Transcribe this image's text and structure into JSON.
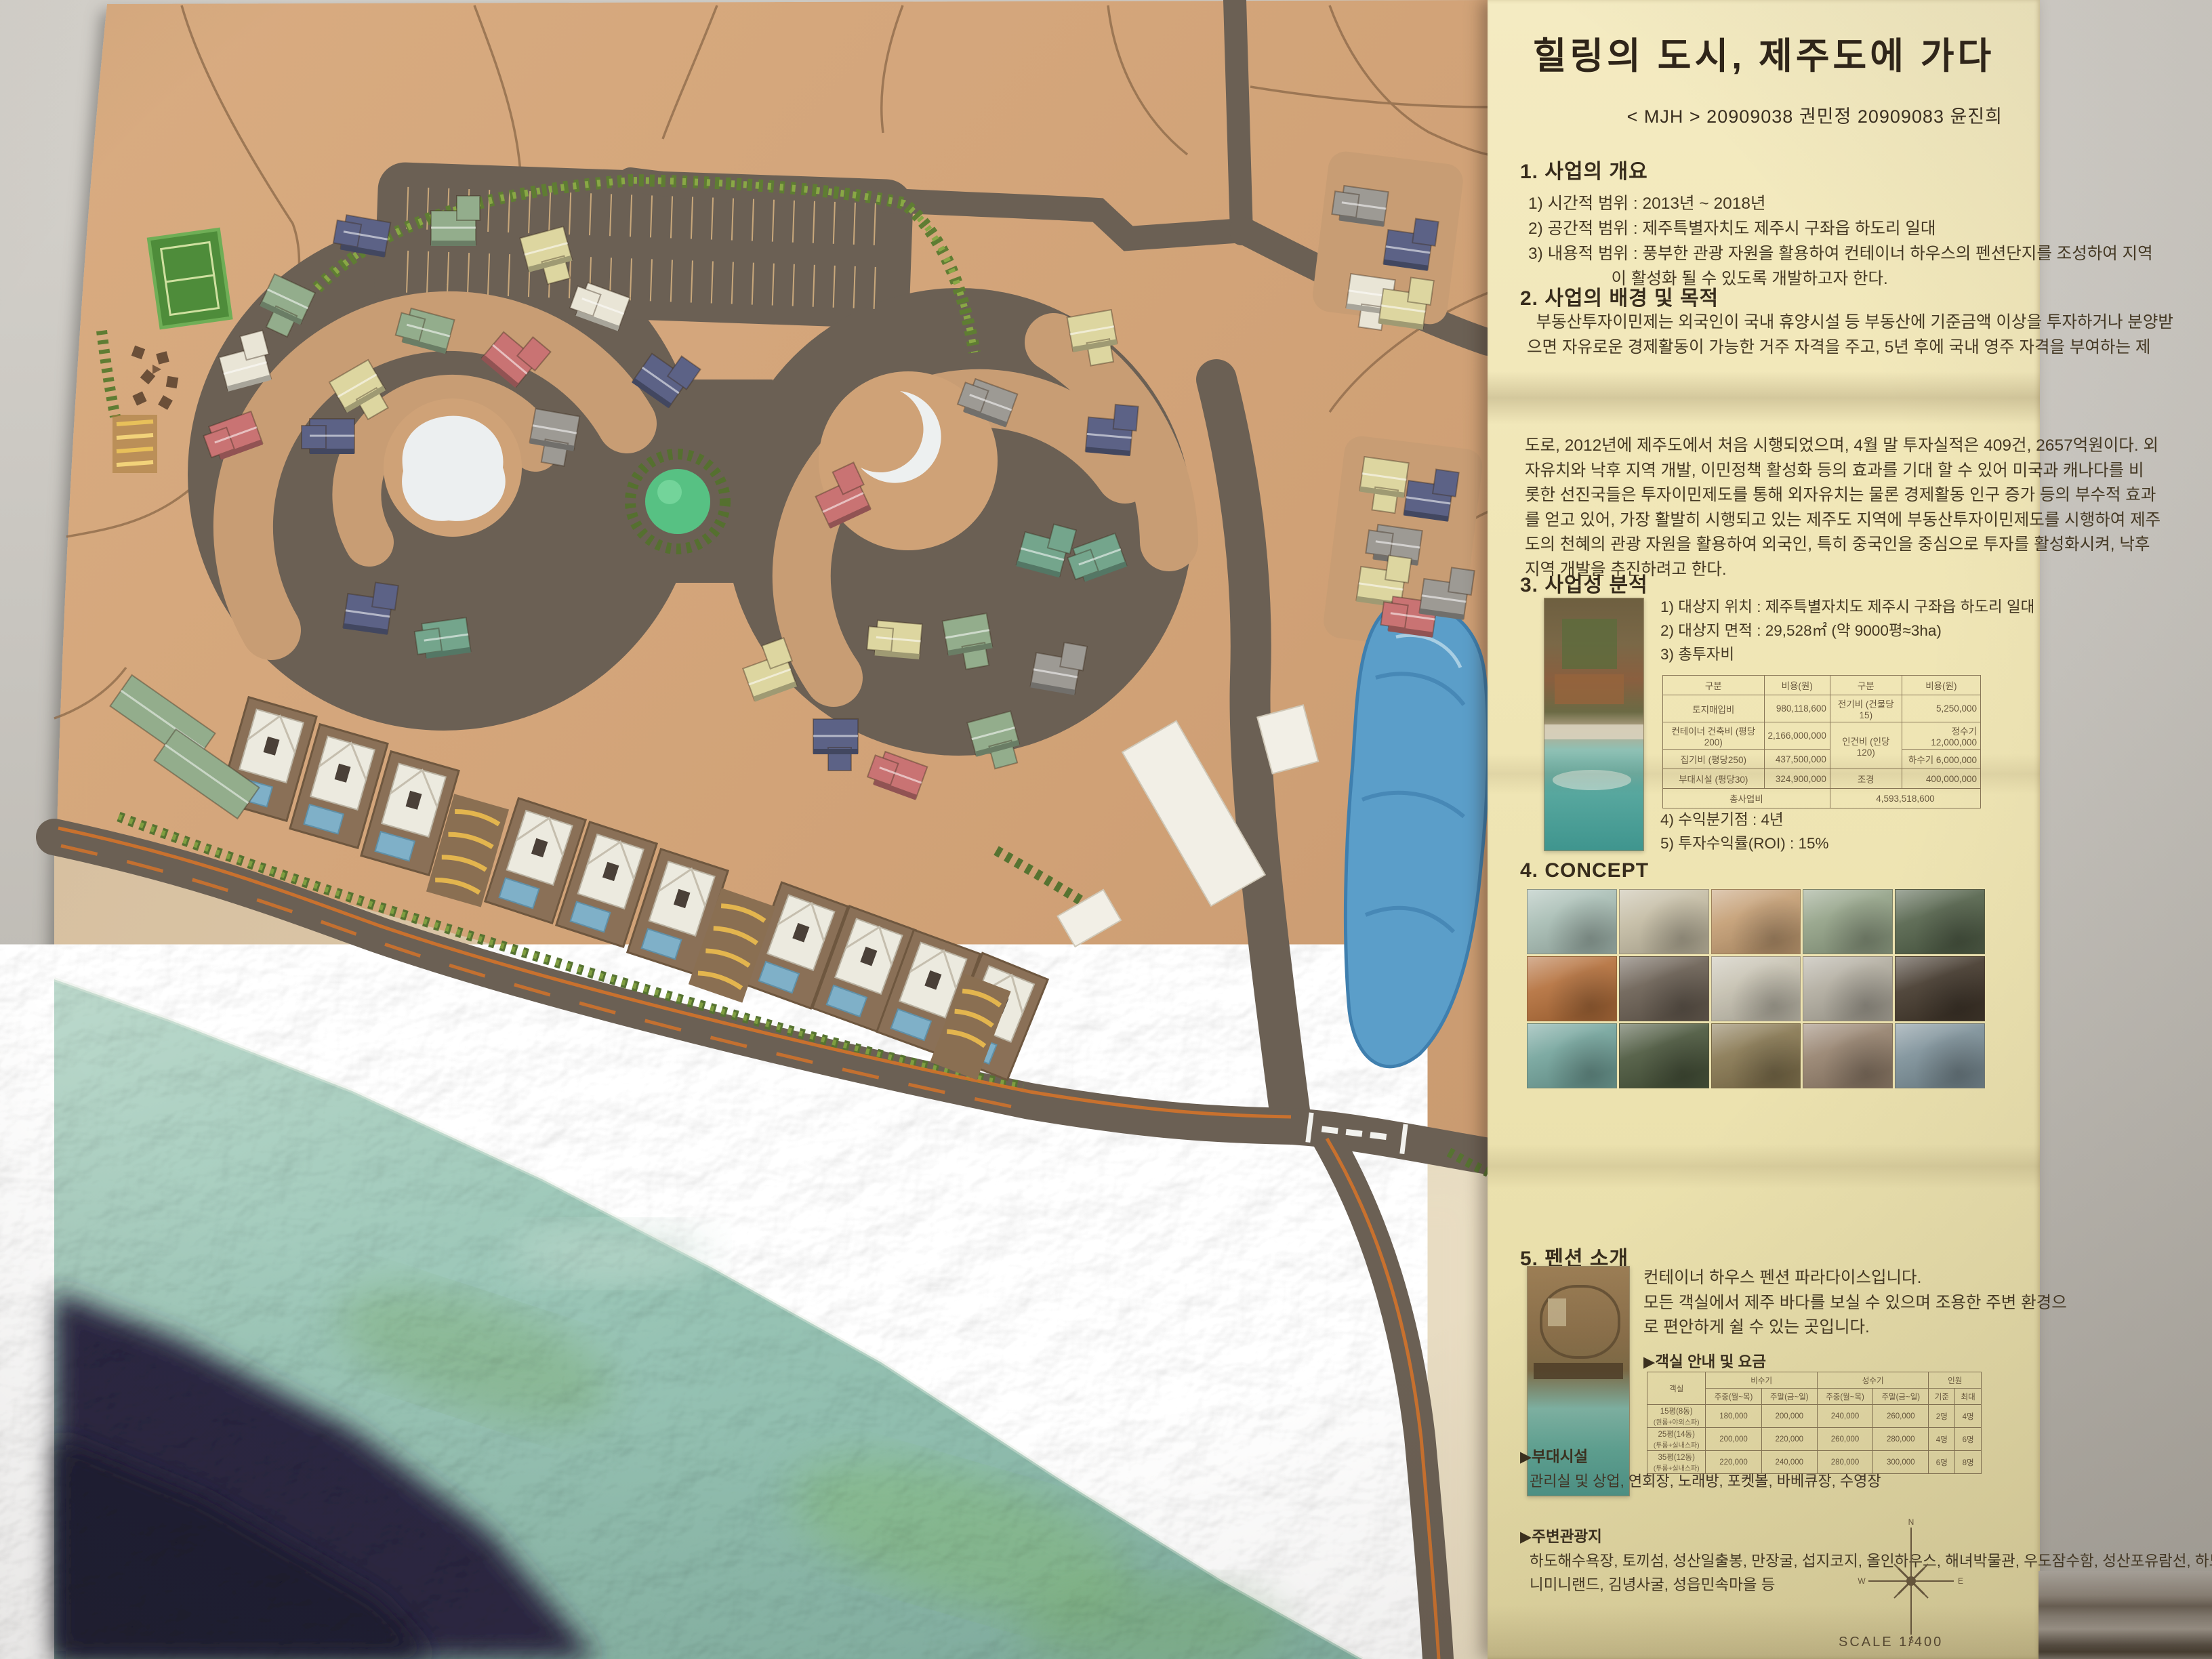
{
  "panel": {
    "title": "힐링의 도시, 제주도에 가다",
    "subtitle": "< MJH > 20909038 권민정 20909083 윤진희",
    "s1": {
      "heading": "1. 사업의 개요",
      "lines": [
        "1) 시간적 범위 : 2013년 ~ 2018년",
        "2) 공간적 범위 : 제주특별자치도 제주시 구좌읍 하도리 일대",
        "3) 내용적 범위 : 풍부한 관광 자원을 활용하여 컨테이너 하우스의 펜션단지를 조성하여 지역",
        "                  이 활성화 될 수 있도록 개발하고자 한다."
      ]
    },
    "s2": {
      "heading": "2. 사업의 배경 및 목적",
      "para1": [
        "  부동산투자이민제는 외국인이 국내 휴양시설 등 부동산에 기준금액 이상을 투자하거나 분양받",
        "으면 자유로운 경제활동이 가능한 거주 자격을 주고, 5년 후에 국내 영주 자격을 부여하는 제"
      ],
      "para2": [
        "도로, 2012년에 제주도에서 처음 시행되었으며, 4월 말 투자실적은 409건, 2657억원이다. 외",
        "자유치와 낙후 지역 개발, 이민정책 활성화 등의 효과를 기대 할 수 있어 미국과 캐나다를 비",
        "롯한 선진국들은 투자이민제도를 통해 외자유치는 물론 경제활동 인구 증가 등의 부수적 효과",
        "를 얻고 있어, 가장 활발히 시행되고 있는 제주도 지역에 부동산투자이민제도를 시행하여 제주",
        "도의 천혜의 관광 자원을 활용하여 외국인, 특히 중국인을 중심으로 투자를 활성화시켜, 낙후",
        "지역 개발을 추진하려고 한다."
      ]
    },
    "s3": {
      "heading": "3. 사업성 분석",
      "items": [
        "1) 대상지 위치 : 제주특별자치도 제주시 구좌읍 하도리 일대",
        "2) 대상지 면적 : 29,528㎡ (약 9000평≈3ha)",
        "3) 총투자비"
      ],
      "items2": [
        "4) 수익분기점 : 4년",
        "5) 투자수익률(ROI) : 15%"
      ],
      "cost_table": {
        "headers": [
          "구분",
          "비용(원)",
          "구분",
          "비용(원)"
        ],
        "rows": [
          [
            "토지매입비",
            "980,118,600",
            "전기비 (건물당15)",
            "5,250,000"
          ],
          [
            "컨테이너 건축비 (평당200)",
            "2,166,000,000",
            "인건비 (인당120)",
            "정수기 12,000,000"
          ],
          [
            "집기비 (평당250)",
            "437,500,000",
            "",
            "하수기 6,000,000"
          ],
          [
            "부대시설 (평당30)",
            "324,900,000",
            "조경",
            "400,000,000"
          ]
        ],
        "total_label": "총사업비",
        "total_value": "4,593,518,600"
      }
    },
    "s4": {
      "heading": "4. CONCEPT",
      "tiles": [
        "#a8bdb4",
        "#c4bca4",
        "#c49e74",
        "#93a287",
        "#55644c",
        "#b4703c",
        "#6b6054",
        "#c6c1b1",
        "#b2ada0",
        "#453a2e",
        "#74a49c",
        "#4c583e",
        "#887852",
        "#97836f",
        "#7f939c"
      ]
    },
    "s5": {
      "heading": "5. 펜션 소개",
      "desc": [
        "컨테이너 하우스 펜션 파라다이스입니다.",
        "모든 객실에서 제주 바다를 보실 수 있으며 조용한 주변 환경으",
        "로 편안하게 쉴 수 있는 곳입니다."
      ],
      "table_label": "▶객실 안내 및 요금",
      "price_table": {
        "room_header": "객실",
        "groups": [
          "비수기",
          "성수기",
          "인원"
        ],
        "sub_headers": [
          "주중(월~목)",
          "주말(금~일)",
          "주중(월~목)",
          "주말(금~일)",
          "기준",
          "최대"
        ],
        "rows": [
          {
            "room": "15평(8동)",
            "room2": "(원룸+야외스파)",
            "vals": [
              "180,000",
              "200,000",
              "240,000",
              "260,000",
              "2명",
              "4명"
            ]
          },
          {
            "room": "25평(14동)",
            "room2": "(투룸+실내스파)",
            "vals": [
              "200,000",
              "220,000",
              "260,000",
              "280,000",
              "4명",
              "6명"
            ]
          },
          {
            "room": "35평(12동)",
            "room2": "(투룸+실내스파)",
            "vals": [
              "220,000",
              "240,000",
              "280,000",
              "300,000",
              "6명",
              "8명"
            ]
          }
        ]
      }
    },
    "facilities": {
      "label": "▶부대시설",
      "text": "관리실 및 상업, 연회장, 노래방, 포켓볼, 바베큐장, 수영장"
    },
    "attractions": {
      "label": "▶주변관광지",
      "lines": [
        "하도해수욕장, 토끼섬, 성산일출봉, 만장굴, 섭지코지, 올인하우스, 해녀박물관, 우도잠수함, 성산포유람선, 하도철새도래지, 미",
        "니미니랜드, 김녕사굴, 성읍민속마을 등"
      ]
    },
    "compass": {
      "n": "N",
      "e": "E",
      "s": "S",
      "w": "W"
    },
    "scale_label": "SCALE 1/400"
  },
  "model": {
    "palette": {
      "navy": "#5c6286",
      "sage": "#93ad8c",
      "teal": "#74a58c",
      "cream": "#ddd6a0",
      "ivory": "#e9e5d6",
      "red": "#c97373",
      "gray": "#9d9a94"
    },
    "houses": [
      [
        344,
        640,
        -20,
        "red",
        1
      ],
      [
        358,
        541,
        -15,
        "ivory",
        0
      ],
      [
        423,
        437,
        25,
        "sage",
        2
      ],
      [
        537,
        344,
        10,
        "navy",
        1
      ],
      [
        666,
        333,
        0,
        "sage",
        0
      ],
      [
        802,
        365,
        -15,
        "cream",
        2
      ],
      [
        888,
        448,
        20,
        "ivory",
        1
      ],
      [
        974,
        557,
        35,
        "navy",
        0
      ],
      [
        523,
        568,
        -30,
        "cream",
        2
      ],
      [
        630,
        484,
        15,
        "sage",
        1
      ],
      [
        752,
        526,
        40,
        "red",
        0
      ],
      [
        816,
        630,
        10,
        "gray",
        2
      ],
      [
        487,
        640,
        0,
        "navy",
        1
      ],
      [
        540,
        902,
        8,
        "navy",
        0
      ],
      [
        655,
        938,
        -8,
        "teal",
        1
      ],
      [
        1240,
        740,
        -25,
        "red",
        0
      ],
      [
        1323,
        940,
        5,
        "cream",
        1
      ],
      [
        1424,
        933,
        -10,
        "sage",
        2
      ],
      [
        1536,
        814,
        15,
        "teal",
        0
      ],
      [
        1460,
        590,
        20,
        "gray",
        1
      ],
      [
        1608,
        485,
        -10,
        "cream",
        2
      ],
      [
        1634,
        640,
        5,
        "navy",
        0
      ],
      [
        1619,
        820,
        -20,
        "teal",
        1
      ],
      [
        1555,
        990,
        10,
        "gray",
        0
      ],
      [
        1462,
        1080,
        -15,
        "sage",
        2
      ],
      [
        1327,
        1140,
        20,
        "red",
        1
      ],
      [
        1230,
        1083,
        0,
        "navy",
        2
      ],
      [
        1132,
        997,
        -20,
        "cream",
        0
      ],
      [
        2010,
        300,
        8,
        "gray",
        1
      ],
      [
        2075,
        365,
        8,
        "navy",
        0
      ],
      [
        2020,
        430,
        8,
        "ivory",
        2
      ],
      [
        2068,
        452,
        8,
        "cream",
        0
      ],
      [
        2040,
        700,
        8,
        "cream",
        2
      ],
      [
        2105,
        735,
        8,
        "navy",
        0
      ],
      [
        2060,
        800,
        8,
        "gray",
        1
      ],
      [
        2035,
        862,
        8,
        "cream",
        0
      ],
      [
        2082,
        906,
        8,
        "red",
        1
      ],
      [
        2128,
        880,
        8,
        "gray",
        0
      ]
    ],
    "units": [
      [
        395,
        1120,
        16
      ],
      [
        500,
        1160,
        16
      ],
      [
        605,
        1200,
        16
      ],
      [
        790,
        1270,
        18
      ],
      [
        895,
        1305,
        18
      ],
      [
        1000,
        1345,
        18
      ],
      [
        1175,
        1395,
        20
      ],
      [
        1275,
        1430,
        20
      ],
      [
        1370,
        1465,
        20
      ],
      [
        1468,
        1500,
        22
      ]
    ],
    "lodges": [
      [
        240,
        1062,
        35
      ],
      [
        305,
        1142,
        35
      ]
    ]
  }
}
